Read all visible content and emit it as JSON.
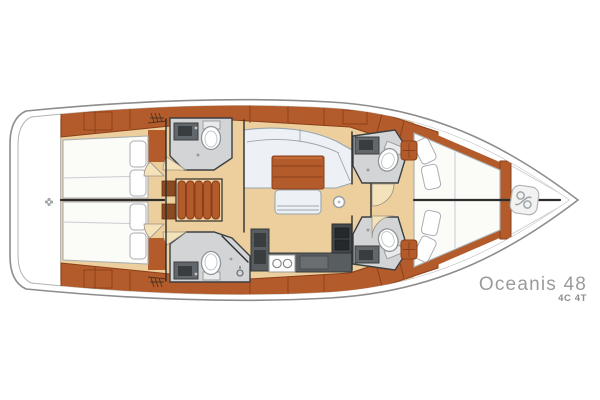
{
  "branding": {
    "model": "Oceanis 48",
    "version": "4C 4T"
  },
  "palette": {
    "hull_line": "#8d8d8d",
    "hull_line2": "#b3b3b3",
    "floor": "#eccf9d",
    "wood": "#b45b2c",
    "wood_dark": "#8a3f18",
    "wood_light": "#cc7740",
    "berth": "#fbfbf8",
    "berth_line": "#a9aeb2",
    "settee": "#edf1f5",
    "settee_line": "#9aa6af",
    "head_floor": "#d2d4d5",
    "head_line": "#3d4043",
    "fixture": "#62676b",
    "fixture_dark": "#393d40",
    "counter": "#585d60",
    "counter_dark": "#35393b",
    "burner": "#26292b",
    "door": "#f3e2ba",
    "door_line": "#9a9287",
    "partition": "#2d2d2d",
    "chain": "#99a1a6",
    "text": "#9b9b9b",
    "text2": "#8c8c8c"
  },
  "icons": {
    "anchor_chain_icon": "chain links in bow locker",
    "toilet_icon": "oval bowl with tank",
    "sink_icon": "dark basin with faucet",
    "stove_icon": "two burners",
    "galley_sinks_icon": "twin round sinks",
    "shower_icon": "shower head with drain",
    "steps_icon": "companionway ladder slats",
    "vent_grate_icon": "hatched grate marks",
    "stern_fitting_icon": "small transom fitting"
  },
  "plan": {
    "type": "yacht-interior-deck-plan",
    "orientation": "bow-right",
    "areas": [
      "stern-platform",
      "aft-cabin-port",
      "aft-cabin-starboard",
      "aft-head-port",
      "aft-head-starboard-with-shower",
      "companionway-steps",
      "saloon-settee",
      "saloon-table",
      "saloon-bench",
      "mast-post",
      "galley",
      "mid-head-port",
      "mid-head-starboard",
      "forward-cabin-vberth",
      "anchor-locker"
    ]
  }
}
